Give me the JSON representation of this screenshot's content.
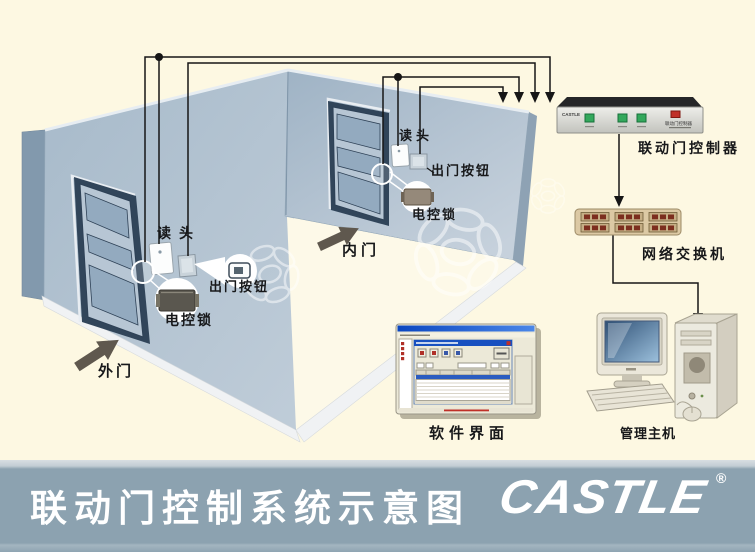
{
  "banner": {
    "title": "联动门控制系统示意图",
    "logo_text": "CASTLE",
    "registered_mark": "®"
  },
  "labels": {
    "outer_door": "外门",
    "inner_door": "内门",
    "outer_reader": "读头",
    "outer_exit_button": "出门按钮",
    "outer_lock": "电控锁",
    "inner_reader": "读头",
    "inner_exit_button": "出门按钮",
    "inner_lock": "电控锁",
    "controller": "联动门控制器",
    "network_switch": "网络交换机",
    "software_ui": "软件界面",
    "management_host": "管理主机"
  },
  "devices": {
    "controller_brand": "CASTLE",
    "controller_faceplate": "联动门控制器"
  },
  "colors": {
    "background": "#fdf8e2",
    "wall_light": "#b6c4d3",
    "wall_dark": "#8299ad",
    "door_frame": "#31455a",
    "banner": "#8ca2b0",
    "banner_text": "#ffffff",
    "wire": "#161616",
    "switch_body": "#dcc9a4",
    "switch_port": "#7c2e1e",
    "controller_led": "#33a85c",
    "controller_indicator": "#c03028",
    "screen_blue": "#35597f"
  }
}
